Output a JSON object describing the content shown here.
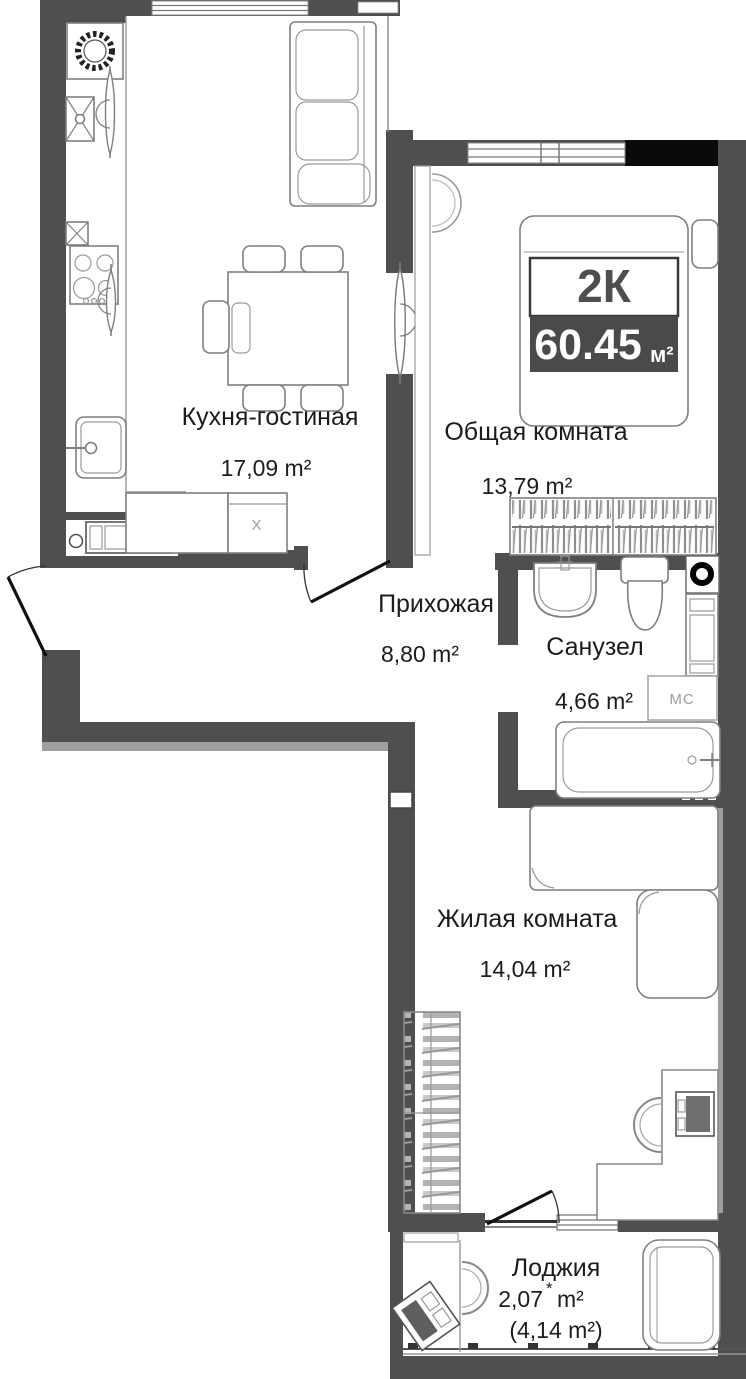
{
  "floor_plan": {
    "title_badge": {
      "rooms": "2К",
      "area": "60.45",
      "unit": "м²"
    },
    "rooms": [
      {
        "id": "kitchen-living",
        "name": "Кухня-гостиная",
        "area": "17,09 m²"
      },
      {
        "id": "common-room",
        "name": "Общая комната",
        "area": "13,79 m²"
      },
      {
        "id": "hallway",
        "name": "Прихожая",
        "area": "8,80 m²"
      },
      {
        "id": "bathroom",
        "name": "Санузел",
        "area": "4,66 m²"
      },
      {
        "id": "living-room",
        "name": "Жилая комната",
        "area": "14,04 m²"
      },
      {
        "id": "loggia",
        "name": "Лоджия",
        "area_value": "2,07",
        "area_star": "*",
        "area_unit": "m²",
        "area_alt": "(4,14 m²)"
      }
    ],
    "annotations": {
      "washing_machine": "МС",
      "kitchen_cabinet": "X"
    },
    "colors": {
      "wall": "#4f4f4f",
      "black_block": "#0a0a0a",
      "badge_bg": "#4a4a4a",
      "badge_text": "#ffffff",
      "furniture_line": "#7f7f7f",
      "label_text": "#1c1c1c"
    }
  }
}
